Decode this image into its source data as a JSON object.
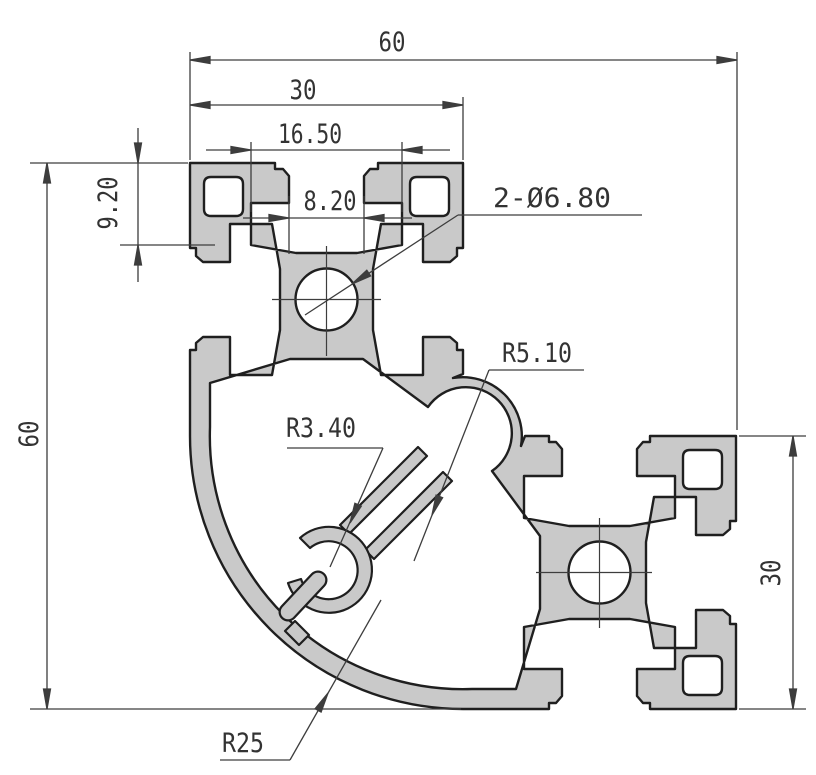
{
  "drawing": {
    "kind": "technical-drawing",
    "subject": "aluminum-extrusion-corner-profile-cross-section",
    "colors": {
      "profile_fill": "#c9c9c9",
      "profile_outline": "#1f1f1f",
      "dimension_lines": "#3d3d3d",
      "text": "#333333",
      "background": "#ffffff"
    },
    "dims": {
      "overall_width": "60",
      "arm_width": "30",
      "slot_inner_width": "16.50",
      "slot_opening": "8.20",
      "slot_depth": "9.20",
      "overall_height": "60",
      "arm_height": "30",
      "center_holes": "2-Ø6.80",
      "radius_slot": "R5.10",
      "radius_boss": "R3.40",
      "radius_corner": "R25"
    }
  }
}
